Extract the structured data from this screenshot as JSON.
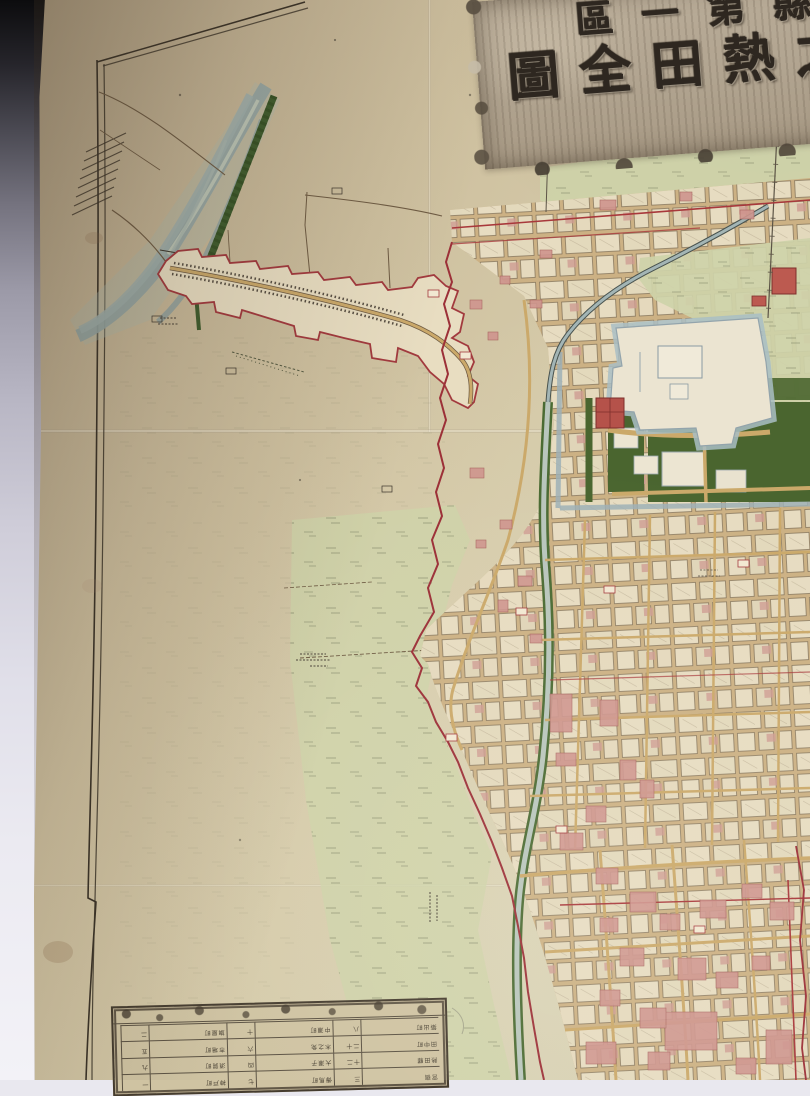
{
  "scene_type": "photograph of a folded Meiji-era Japanese woodblock town map",
  "cartouche": {
    "reading_order": "right-to-left",
    "visible_text": "…縣第一區 / 之熱田全圖",
    "rows": [
      {
        "chars": [
          "縣",
          "第",
          "一",
          "區"
        ],
        "note": "rightmost character cropped by photo edge"
      },
      {
        "chars": [
          "之",
          "熱",
          "田",
          "全",
          "圖"
        ],
        "note": "rightmost character cropped by photo edge"
      }
    ]
  },
  "legend_table": {
    "orientation": "printed upside-down (rotated 180°)",
    "rows": 4,
    "cols": 6,
    "approx": true,
    "note": "distance table; tiny cell text illegible in source photograph",
    "cells": [
      [
        "宮宿",
        "三",
        "傳馬町",
        "七",
        "神戸町",
        "一"
      ],
      [
        "熱田驛",
        "十二",
        "大瀬子",
        "四",
        "須賀町",
        "九"
      ],
      [
        "田中町",
        "二十",
        "木之免",
        "六",
        "市場町",
        "五"
      ],
      [
        "築出町",
        "八",
        "中瀬町",
        "十",
        "旗屋町",
        "二"
      ]
    ]
  },
  "features": [
    "border-frame",
    "braided-river",
    "levee",
    "roadside-ribbon-town",
    "town-grid",
    "castle-compound",
    "moat",
    "parks",
    "canal",
    "rice-fields",
    "distance-table",
    "red-ward-boundary",
    "fold-creases",
    "stains"
  ],
  "colors": {
    "background_top": "#0c0c0e",
    "background_bottom": "#f3f2f7",
    "paper": "#cec09f",
    "paper_shadowed": "#b2a184",
    "field_green": "#ced3a9",
    "park_green": "#4a652f",
    "water_gray": "#a3b5b5",
    "canal_bank_green": "#4b6b33",
    "town_cream": "#e1d7bc",
    "street_tan": "#cba96a",
    "building_pink": "#cf958e",
    "boundary_red": "#9c3038",
    "ink": "#3a332a",
    "cartouche_wood": "#b2a591"
  }
}
